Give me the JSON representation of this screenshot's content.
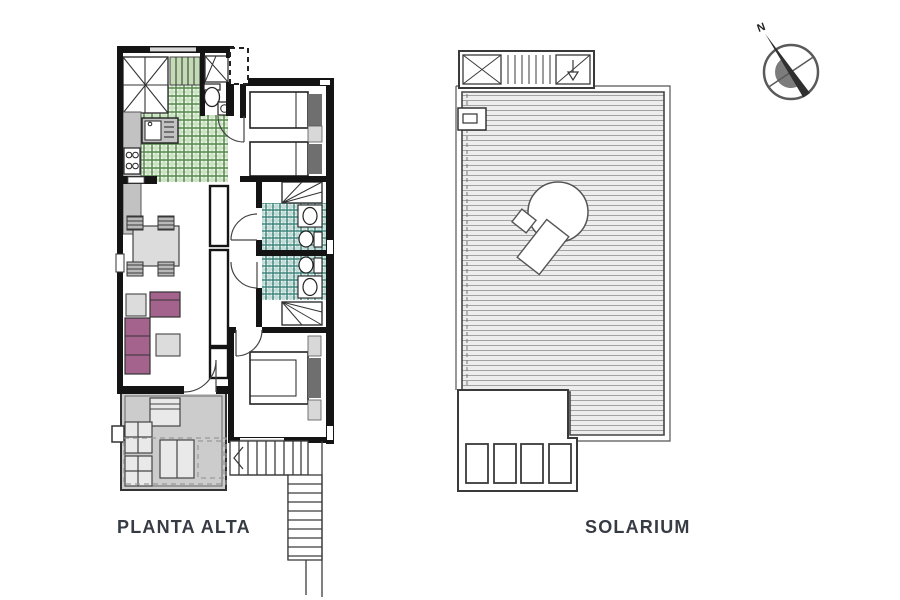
{
  "plans": {
    "planta_alta": {
      "label": "PLANTA ALTA"
    },
    "solarium": {
      "label": "SOLARIUM"
    }
  },
  "compass": {
    "north_label": "N"
  },
  "colors": {
    "wall": "#141414",
    "label_text": "#363b44",
    "kitchen_tile_line": "#4c8242",
    "bath_tile_line": "#2f7c72",
    "stair_landing_fill": "#c3dcb5",
    "terrace_floor": "#cccccc",
    "sofa": "#a4638c",
    "furniture_gray": "#dcdcdc",
    "headboard_dark": "#6f6f6f",
    "deck_stripe_line": "#a2a2a2"
  }
}
